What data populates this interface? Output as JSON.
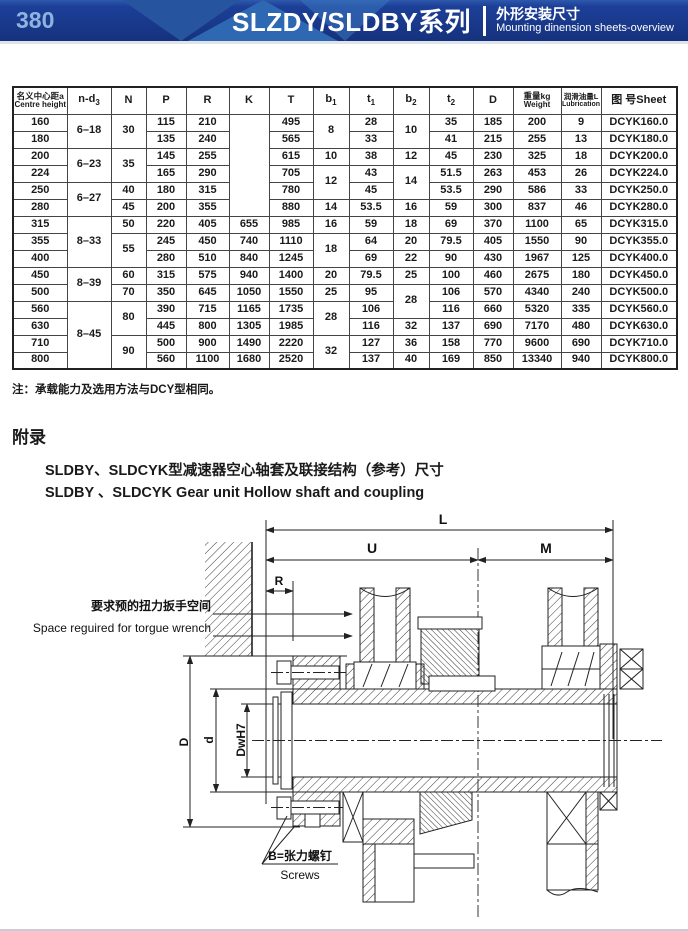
{
  "header": {
    "page_number": "380",
    "title": "SLZDY/SLDBY系列",
    "subtitle_zh": "外形安装尺寸",
    "subtitle_en": "Mounting dinension sheets-overview",
    "colors": {
      "band": "#1c3f98",
      "accent": "#2f68b2",
      "page_number": "#8fb3e0"
    }
  },
  "table": {
    "columns": [
      {
        "zh": "名义中心距a",
        "en": "Centre height"
      },
      {
        "base": "n-d",
        "sub": "3"
      },
      {
        "base": "N"
      },
      {
        "base": "P"
      },
      {
        "base": "R"
      },
      {
        "base": "K"
      },
      {
        "base": "T"
      },
      {
        "base": "b",
        "sub": "1"
      },
      {
        "base": "t",
        "sub": "1"
      },
      {
        "base": "b",
        "sub": "2"
      },
      {
        "base": "t",
        "sub": "2"
      },
      {
        "base": "D"
      },
      {
        "zh": "重量kg",
        "en": "Weight"
      },
      {
        "zh": "润滑油量L",
        "en": "Lubrication"
      },
      {
        "base": "图 号Sheet"
      }
    ],
    "rows": [
      [
        "160",
        {
          "v": "6–18",
          "rs": 2
        },
        {
          "v": "30",
          "rs": 2
        },
        "115",
        "210",
        {
          "v": "",
          "rs": 6
        },
        "495",
        {
          "v": "8",
          "rs": 2
        },
        "28",
        {
          "v": "10",
          "rs": 2
        },
        "35",
        "185",
        "200",
        "9",
        "DCYK160.0"
      ],
      [
        "180",
        "135",
        "240",
        "565",
        "33",
        "41",
        "215",
        "255",
        "13",
        "DCYK180.0"
      ],
      [
        "200",
        {
          "v": "6–23",
          "rs": 2
        },
        {
          "v": "35",
          "rs": 2
        },
        "145",
        "255",
        "615",
        "10",
        "38",
        "12",
        "45",
        "230",
        "325",
        "18",
        "DCYK200.0"
      ],
      [
        "224",
        "165",
        "290",
        "705",
        {
          "v": "12",
          "rs": 2
        },
        "43",
        {
          "v": "14",
          "rs": 2
        },
        "51.5",
        "263",
        "453",
        "26",
        "DCYK224.0"
      ],
      [
        "250",
        {
          "v": "6–27",
          "rs": 2
        },
        "40",
        "180",
        "315",
        "780",
        "45",
        "53.5",
        "290",
        "586",
        "33",
        "DCYK250.0"
      ],
      [
        "280",
        "45",
        "200",
        "355",
        "880",
        "14",
        "53.5",
        "16",
        "59",
        "300",
        "837",
        "46",
        "DCYK280.0"
      ],
      [
        "315",
        {
          "v": "8–33",
          "rs": 3
        },
        "50",
        "220",
        "405",
        "655",
        "985",
        "16",
        "59",
        "18",
        "69",
        "370",
        "1100",
        "65",
        "DCYK315.0"
      ],
      [
        "355",
        {
          "v": "55",
          "rs": 2
        },
        "245",
        "450",
        "740",
        "1110",
        {
          "v": "18",
          "rs": 2
        },
        "64",
        "20",
        "79.5",
        "405",
        "1550",
        "90",
        "DCYK355.0"
      ],
      [
        "400",
        "280",
        "510",
        "840",
        "1245",
        "69",
        "22",
        "90",
        "430",
        "1967",
        "125",
        "DCYK400.0"
      ],
      [
        "450",
        {
          "v": "8–39",
          "rs": 2
        },
        "60",
        "315",
        "575",
        "940",
        "1400",
        "20",
        "79.5",
        "25",
        "100",
        "460",
        "2675",
        "180",
        "DCYK450.0"
      ],
      [
        "500",
        "70",
        "350",
        "645",
        "1050",
        "1550",
        "25",
        "95",
        {
          "v": "28",
          "rs": 2
        },
        "106",
        "570",
        "4340",
        "240",
        "DCYK500.0"
      ],
      [
        "560",
        {
          "v": "8–45",
          "rs": 4
        },
        {
          "v": "80",
          "rs": 2
        },
        "390",
        "715",
        "1165",
        "1735",
        {
          "v": "28",
          "rs": 2
        },
        "106",
        "116",
        "660",
        "5320",
        "335",
        "DCYK560.0"
      ],
      [
        "630",
        "445",
        "800",
        "1305",
        "1985",
        "116",
        "32",
        "137",
        "690",
        "7170",
        "480",
        "DCYK630.0"
      ],
      [
        "710",
        {
          "v": "90",
          "rs": 2
        },
        "500",
        "900",
        "1490",
        "2220",
        {
          "v": "32",
          "rs": 2
        },
        "127",
        "36",
        "158",
        "770",
        "9600",
        "690",
        "DCYK710.0"
      ],
      [
        "800",
        "560",
        "1100",
        "1680",
        "2520",
        "137",
        "40",
        "169",
        "850",
        "13340",
        "940",
        "DCYK800.0"
      ]
    ]
  },
  "note": "注：承载能力及选用方法与DCY型相同。",
  "appendix": {
    "label": "附录",
    "title_zh": "SLDBY、SLDCYK型减速器空心轴套及联接结构（参考）尺寸",
    "title_en": "SLDBY 、SLDCYK Gear unit Hollow shaft and coupling"
  },
  "drawing": {
    "dims": {
      "L": "L",
      "U": "U",
      "M": "M",
      "R": "R",
      "D": "D",
      "d": "d",
      "dw": "DwH7"
    },
    "torque_zh": "要求预的扭力扳手空间",
    "torque_en": "Space reguired for torgue wrench",
    "screws_zh": "B=张力螺钉",
    "screws_en": "Screws",
    "caption": "图9"
  }
}
